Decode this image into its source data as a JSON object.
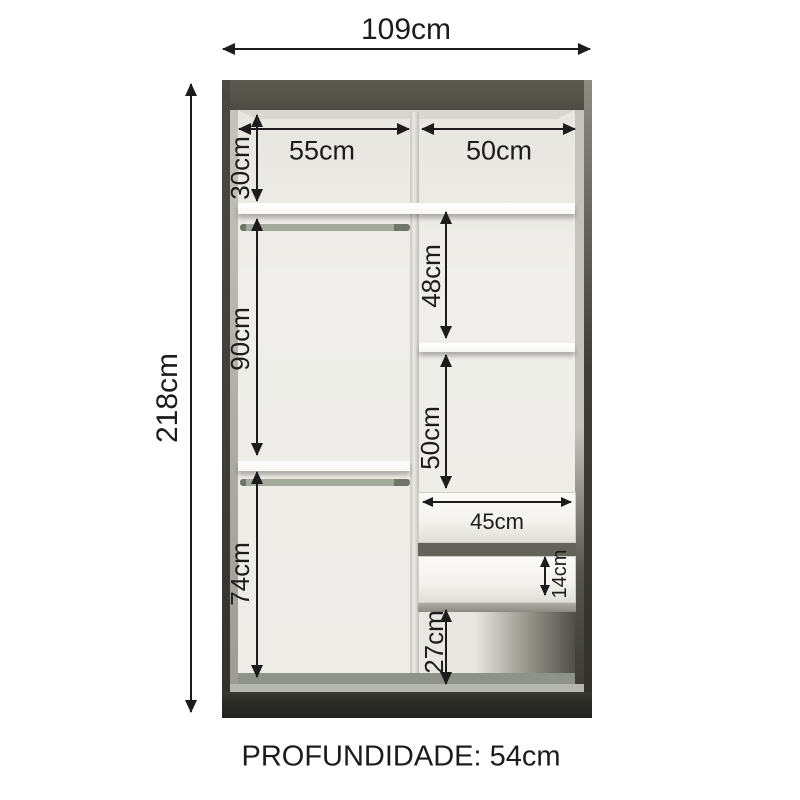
{
  "colors": {
    "background": "#ffffff",
    "dimension": "#1c1c1c",
    "frame": "#54534a",
    "frame_edge": "#3e3d36",
    "interior": "#efeeea",
    "inner_wall": "#c4c3bc",
    "divider": "#e4e3dd",
    "shelf": "#f8f7f3",
    "rod": "#979c90",
    "drawer": "#f4f3ef",
    "drawer_gap": "#63635c",
    "floor": "#8e9289",
    "floor_edge": "#b6b8b0",
    "base": "#2a2a26"
  },
  "dimensions": {
    "overall_width": "109cm",
    "overall_height": "218cm",
    "depth": "PROFUNDIDADE: 54cm",
    "left_column_width": "55cm",
    "right_column_width": "50cm",
    "top_section_height": "30cm",
    "left_hanging_section_height": "90cm",
    "left_bottom_section_height": "74cm",
    "right_upper_section_height": "48cm",
    "right_middle_section_height": "50cm",
    "drawer_width": "45cm",
    "drawer_front_height": "14cm",
    "right_bottom_section_height": "27cm"
  }
}
